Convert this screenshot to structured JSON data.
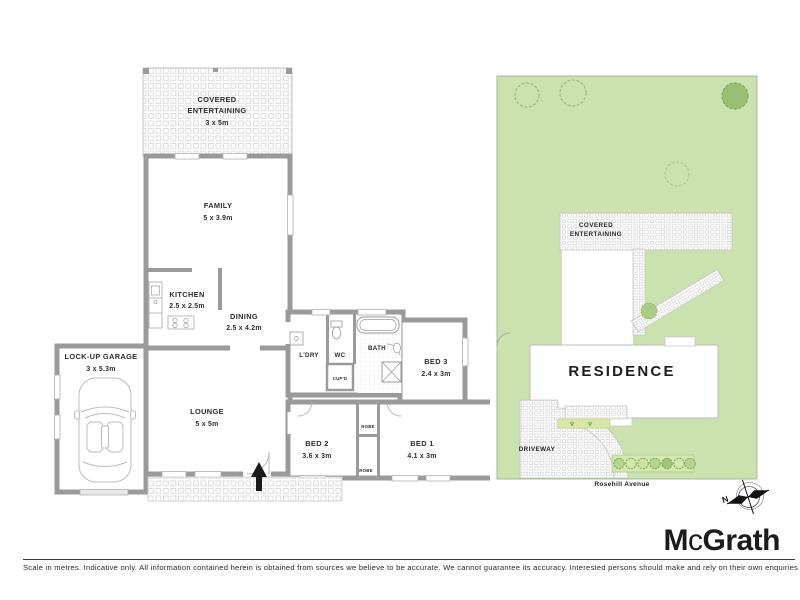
{
  "floor_plan": {
    "covered_entertaining": {
      "line1": "COVERED",
      "line2": "ENTERTAINING",
      "dims": "3 x 5m"
    },
    "family": {
      "name": "FAMILY",
      "dims": "5 x 3.9m"
    },
    "kitchen": {
      "name": "KITCHEN",
      "dims": "2.5 x 2.5m"
    },
    "dining": {
      "name": "DINING",
      "dims": "2.5 x 4.2m"
    },
    "garage": {
      "name": "LOCK-UP GARAGE",
      "dims": "3 x 5.3m"
    },
    "lounge": {
      "name": "LOUNGE",
      "dims": "5 x 5m"
    },
    "laundry": {
      "name": "L'DRY"
    },
    "wc": {
      "name": "WC"
    },
    "cupboard": {
      "name": "CUP'D"
    },
    "bath": {
      "name": "BATH"
    },
    "bed3": {
      "name": "BED 3",
      "dims": "2.4 x 3m"
    },
    "bed2": {
      "name": "BED 2",
      "dims": "3.6 x 3m"
    },
    "bed1": {
      "name": "BED 1",
      "dims": "4.1 x 3m"
    },
    "robe": "ROBE"
  },
  "site_plan": {
    "covered_entertaining": {
      "line1": "COVERED",
      "line2": "ENTERTAINING"
    },
    "residence": "RESIDENCE",
    "driveway": "DRIVEWAY",
    "street": "Rosehill Avenue",
    "compass_north": "N"
  },
  "branding": {
    "logo_m": "M",
    "logo_c": "c",
    "logo_rest": "Grath"
  },
  "footer": {
    "disclaimer": "Scale in metres. Indicative only. All information contained herein is obtained from sources we believe to be accurate. We cannot guarantee its accuracy. Interested persons should make and rely on their own enquiries"
  },
  "colors": {
    "wall": "#9a9a9a",
    "lawn": "#cae2ae",
    "tree_stroke": "#96bd74",
    "paver_line": "#dddddd",
    "hedge": "#d9e9a5",
    "garden_bed": "#d4e7ad",
    "logo": "#1b1b1b"
  }
}
